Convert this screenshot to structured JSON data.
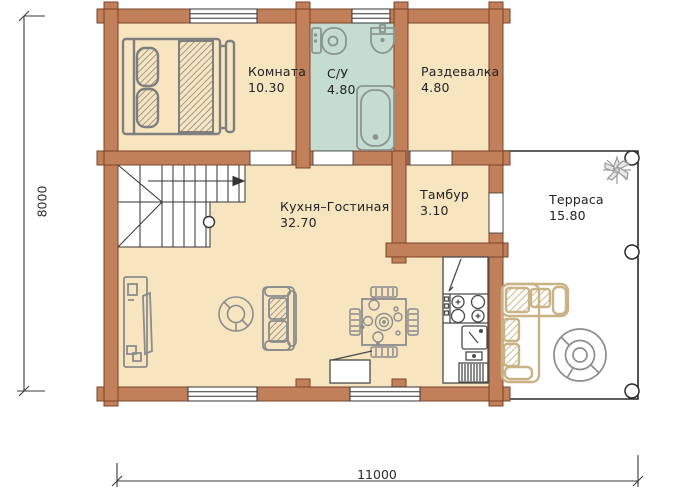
{
  "rooms": [
    {
      "name": "Комната",
      "area": "10.30"
    },
    {
      "name": "С/У",
      "area": "4.80"
    },
    {
      "name": "Раздевалка",
      "area": "4.80"
    },
    {
      "name": "Кухня–Гостиная",
      "area": "32.70"
    },
    {
      "name": "Тамбур",
      "area": "3.10"
    },
    {
      "name": "Терраса",
      "area": "15.80"
    }
  ],
  "dimensions": {
    "left_mm": "8000",
    "bottom_mm": "11000"
  },
  "furniture_icons": [
    "bed",
    "toilet",
    "washbasin",
    "bathtub",
    "stairs",
    "tv-stand",
    "round-armchair",
    "sofa",
    "dining-table",
    "fridge",
    "stove",
    "kitchen-sink",
    "kitchen-cabinet",
    "storage-bench",
    "corner-sofa",
    "round-table",
    "plant",
    "column"
  ],
  "colors": {
    "wall": "#c2805a",
    "wall_outline": "#7a4328",
    "floor": "#f7e5c0",
    "bathroom_floor": "#c5dcd1",
    "terrace_floor": "#ffffff",
    "furniture_outline": "#7f7f7f",
    "fixture_outline": "#8a958f",
    "terrace_furniture_outline": "#c9b285",
    "line": "#333333",
    "text": "#222222"
  }
}
